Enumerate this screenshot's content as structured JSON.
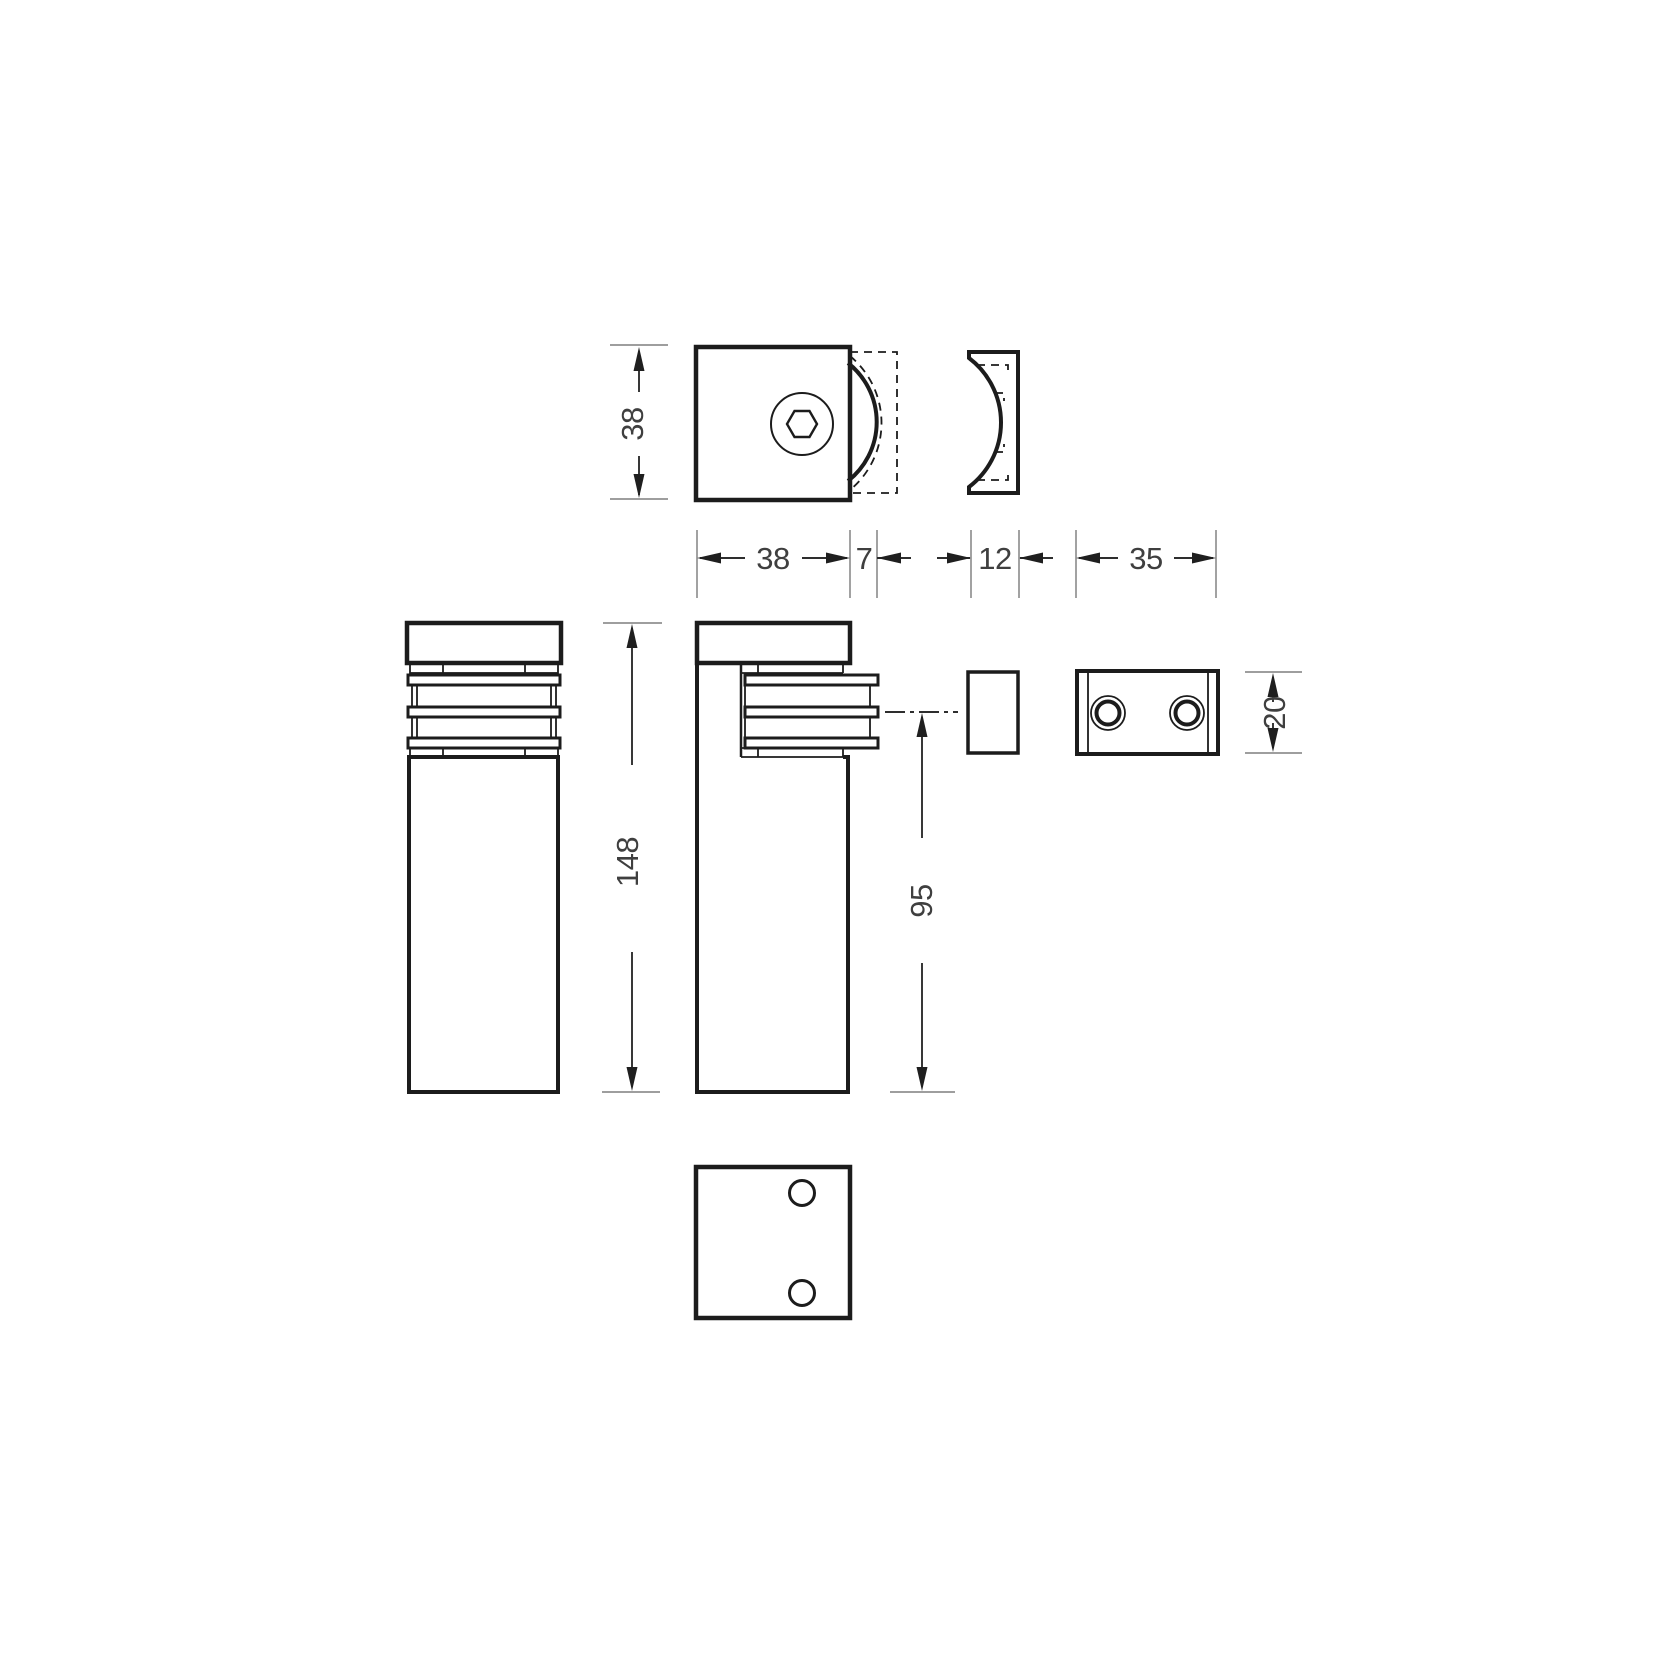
{
  "drawing": {
    "type": "technical-dimension-drawing",
    "views": {
      "top_view": "clamp top view with hex socket screw",
      "spacer_profile": "curved spacer profile",
      "front_view": "louvered clamp front elevation",
      "side_view": "louvered clamp side elevation",
      "spacer_side": "spacer side view",
      "wall_plate": "wall plate with two holes",
      "bottom_view": "bottom view with two holes"
    },
    "dims": {
      "square_size": "38",
      "clamp_width": "38",
      "overhang": "7",
      "spacer_thickness": "12",
      "plate_width": "35",
      "overall_height": "148",
      "body_height": "95",
      "plate_height": "20"
    },
    "colors": {
      "background": "#ffffff",
      "outline": "#1c1c1c",
      "dimension_line": "#2e2e2e",
      "extension_line": "#9e9e9e",
      "text": "#3f3f3f"
    }
  }
}
